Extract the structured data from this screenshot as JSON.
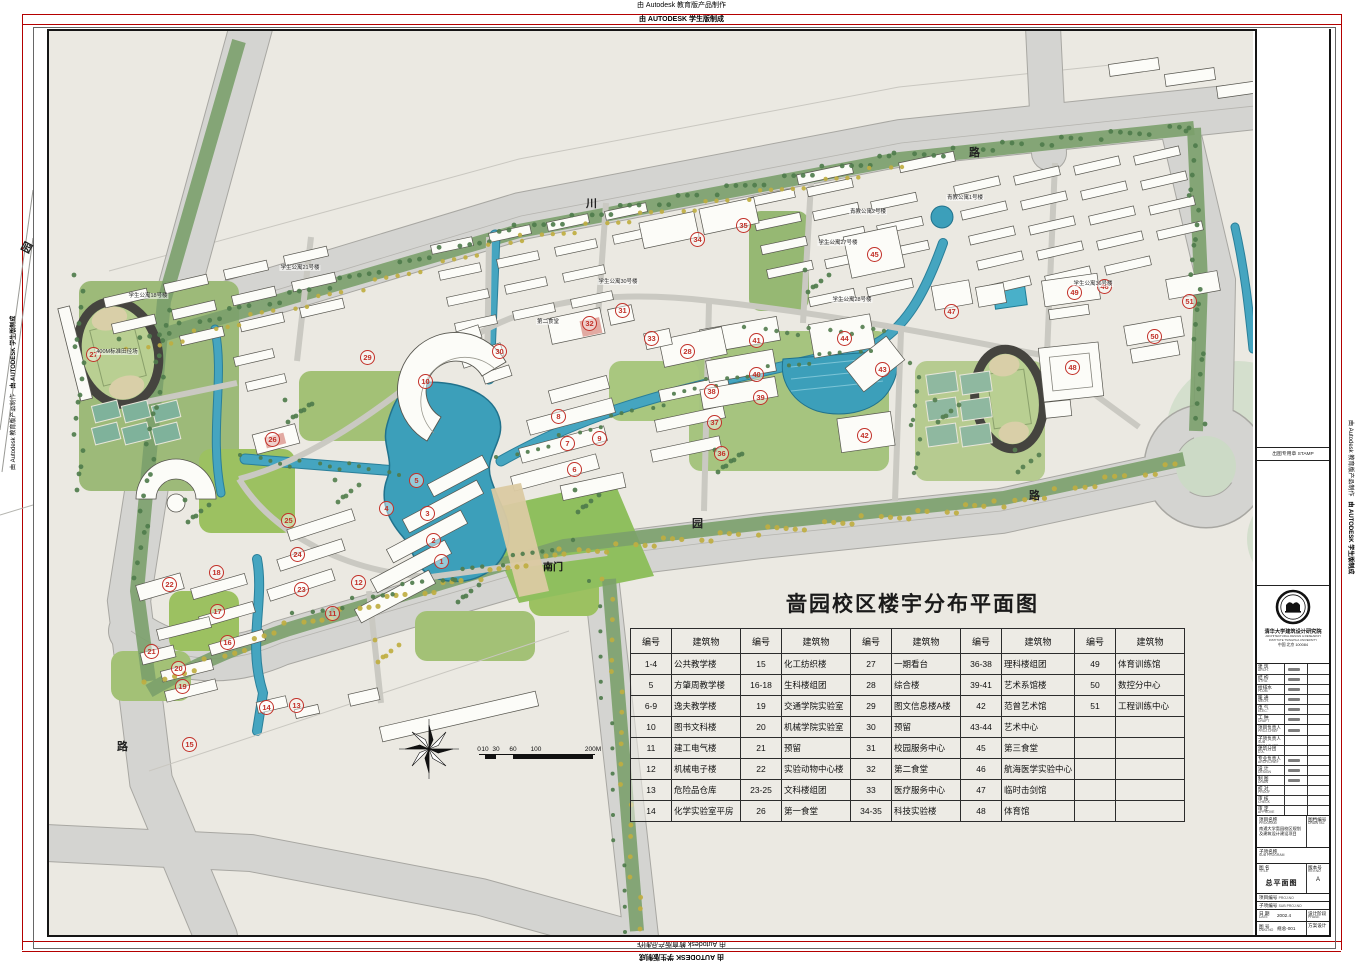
{
  "watermark": {
    "line1": "由 Autodesk 教育版产品制作",
    "line2": "由 AUTODESK 学生版制成"
  },
  "title": "啬园校区楼宇分布平面图",
  "legend_table": {
    "id_header": "编号",
    "name_header": "建筑物",
    "columns": [
      [
        {
          "id": "1-4",
          "name": "公共教学楼"
        },
        {
          "id": "5",
          "name": "方肇周教学楼"
        },
        {
          "id": "6-9",
          "name": "逸夫教学楼"
        },
        {
          "id": "10",
          "name": "图书文科楼"
        },
        {
          "id": "11",
          "name": "建工电气楼"
        },
        {
          "id": "12",
          "name": "机械电子楼"
        },
        {
          "id": "13",
          "name": "危险品仓库"
        },
        {
          "id": "14",
          "name": "化学实验室平房"
        }
      ],
      [
        {
          "id": "15",
          "name": "化工纺织楼"
        },
        {
          "id": "16-18",
          "name": "生科楼组团"
        },
        {
          "id": "19",
          "name": "交通学院实验室"
        },
        {
          "id": "20",
          "name": "机械学院实验室"
        },
        {
          "id": "21",
          "name": "预留"
        },
        {
          "id": "22",
          "name": "实验动物中心楼"
        },
        {
          "id": "23-25",
          "name": "文科楼组团"
        },
        {
          "id": "26",
          "name": "第一食堂"
        }
      ],
      [
        {
          "id": "27",
          "name": "一期看台"
        },
        {
          "id": "28",
          "name": "综合楼"
        },
        {
          "id": "29",
          "name": "图文信息楼A楼"
        },
        {
          "id": "30",
          "name": "预留"
        },
        {
          "id": "31",
          "name": "校园服务中心"
        },
        {
          "id": "32",
          "name": "第二食堂"
        },
        {
          "id": "33",
          "name": "医疗服务中心"
        },
        {
          "id": "34-35",
          "name": "科技实验楼"
        }
      ],
      [
        {
          "id": "36-38",
          "name": "理科楼组团"
        },
        {
          "id": "39-41",
          "name": "艺术系馆楼"
        },
        {
          "id": "42",
          "name": "范曾艺术馆"
        },
        {
          "id": "43-44",
          "name": "艺术中心"
        },
        {
          "id": "45",
          "name": "第三食堂"
        },
        {
          "id": "46",
          "name": "航海医学实验中心"
        },
        {
          "id": "47",
          "name": "临时击剑馆"
        },
        {
          "id": "48",
          "name": "体育馆"
        }
      ],
      [
        {
          "id": "49",
          "name": "体育训练馆"
        },
        {
          "id": "50",
          "name": "数控分中心"
        },
        {
          "id": "51",
          "name": "工程训练中心"
        },
        {
          "id": "",
          "name": ""
        },
        {
          "id": "",
          "name": ""
        },
        {
          "id": "",
          "name": ""
        },
        {
          "id": "",
          "name": ""
        },
        {
          "id": "",
          "name": ""
        }
      ]
    ]
  },
  "map": {
    "colors": {
      "water": "#45a5c0",
      "road": "#d4d4d1",
      "marker_red": "#c23028",
      "lawn": "#9cc161"
    },
    "markers": [
      {
        "n": 1,
        "x": 442,
        "y": 562
      },
      {
        "n": 2,
        "x": 434,
        "y": 541
      },
      {
        "n": 3,
        "x": 428,
        "y": 514
      },
      {
        "n": 4,
        "x": 387,
        "y": 509
      },
      {
        "n": 5,
        "x": 417,
        "y": 481
      },
      {
        "n": 6,
        "x": 575,
        "y": 470
      },
      {
        "n": 7,
        "x": 568,
        "y": 444
      },
      {
        "n": 8,
        "x": 559,
        "y": 417
      },
      {
        "n": 9,
        "x": 600,
        "y": 439
      },
      {
        "n": 10,
        "x": 426,
        "y": 382
      },
      {
        "n": 11,
        "x": 333,
        "y": 614
      },
      {
        "n": 12,
        "x": 359,
        "y": 583
      },
      {
        "n": 13,
        "x": 297,
        "y": 706
      },
      {
        "n": 14,
        "x": 267,
        "y": 708
      },
      {
        "n": 15,
        "x": 190,
        "y": 745
      },
      {
        "n": 16,
        "x": 228,
        "y": 643
      },
      {
        "n": 17,
        "x": 218,
        "y": 612
      },
      {
        "n": 18,
        "x": 217,
        "y": 573
      },
      {
        "n": 19,
        "x": 183,
        "y": 687
      },
      {
        "n": 20,
        "x": 179,
        "y": 669
      },
      {
        "n": 21,
        "x": 152,
        "y": 652
      },
      {
        "n": 22,
        "x": 170,
        "y": 585
      },
      {
        "n": 23,
        "x": 302,
        "y": 590
      },
      {
        "n": 24,
        "x": 298,
        "y": 555
      },
      {
        "n": 25,
        "x": 289,
        "y": 521
      },
      {
        "n": 26,
        "x": 273,
        "y": 440
      },
      {
        "n": 27,
        "x": 94,
        "y": 355
      },
      {
        "n": 28,
        "x": 688,
        "y": 352
      },
      {
        "n": 29,
        "x": 368,
        "y": 358
      },
      {
        "n": 30,
        "x": 500,
        "y": 352
      },
      {
        "n": 31,
        "x": 623,
        "y": 311
      },
      {
        "n": 32,
        "x": 590,
        "y": 324
      },
      {
        "n": 33,
        "x": 652,
        "y": 339
      },
      {
        "n": 34,
        "x": 698,
        "y": 240
      },
      {
        "n": 35,
        "x": 744,
        "y": 226
      },
      {
        "n": 36,
        "x": 722,
        "y": 454
      },
      {
        "n": 37,
        "x": 715,
        "y": 423
      },
      {
        "n": 38,
        "x": 712,
        "y": 392
      },
      {
        "n": 39,
        "x": 761,
        "y": 398
      },
      {
        "n": 40,
        "x": 757,
        "y": 375
      },
      {
        "n": 41,
        "x": 757,
        "y": 341
      },
      {
        "n": 42,
        "x": 865,
        "y": 436
      },
      {
        "n": 43,
        "x": 883,
        "y": 370
      },
      {
        "n": 44,
        "x": 845,
        "y": 339
      },
      {
        "n": 45,
        "x": 875,
        "y": 255
      },
      {
        "n": 46,
        "x": 1105,
        "y": 287
      },
      {
        "n": 47,
        "x": 952,
        "y": 312
      },
      {
        "n": 48,
        "x": 1073,
        "y": 368
      },
      {
        "n": 49,
        "x": 1075,
        "y": 293
      },
      {
        "n": 50,
        "x": 1155,
        "y": 337
      },
      {
        "n": 51,
        "x": 1190,
        "y": 302
      }
    ],
    "road_labels": [
      {
        "text": "川",
        "x": 592,
        "y": 203,
        "rot": 0
      },
      {
        "text": "路",
        "x": 975,
        "y": 152,
        "rot": 0
      },
      {
        "text": "园",
        "x": 698,
        "y": 523,
        "rot": 0
      },
      {
        "text": "路",
        "x": 1035,
        "y": 495,
        "rot": 0
      },
      {
        "text": "路",
        "x": 123,
        "y": 746,
        "rot": 0
      },
      {
        "text": "园",
        "x": 27,
        "y": 247,
        "rot": -62
      }
    ],
    "gate_label": {
      "text": "南门",
      "x": 553,
      "y": 566
    },
    "building_labels": [
      {
        "text": "青教公寓1号楼",
        "x": 965,
        "y": 198
      },
      {
        "text": "青教公寓2号楼",
        "x": 868,
        "y": 212
      },
      {
        "text": "第二食堂",
        "x": 548,
        "y": 322
      },
      {
        "text": "学生公寓21号楼",
        "x": 300,
        "y": 268
      },
      {
        "text": "学生公寓18号楼",
        "x": 148,
        "y": 296
      },
      {
        "text": "学生公寓27号楼",
        "x": 838,
        "y": 243
      },
      {
        "text": "学生公寓28号楼",
        "x": 852,
        "y": 300
      },
      {
        "text": "学生公寓30号楼",
        "x": 618,
        "y": 282
      },
      {
        "text": "学生公寓36号楼",
        "x": 1093,
        "y": 284
      },
      {
        "text": "400M标准田径场",
        "x": 117,
        "y": 352
      }
    ],
    "scale_bar": {
      "ticks": [
        "0",
        "10",
        "30",
        "60",
        "100",
        "200M"
      ]
    }
  },
  "title_block": {
    "stamp_label": "出图专用章 STAMP",
    "institute": {
      "name": "清华大学建筑设计研究院",
      "sub": "ARCHITECTURAL DESIGN & RESEARCH INSTITUTE TSINGHUA UNIVERSITY",
      "addr": "中国 北京 100084"
    },
    "disciplines": [
      {
        "cn": "建 筑",
        "en": "ARCH."
      },
      {
        "cn": "结 构",
        "en": "STRU."
      },
      {
        "cn": "给排水",
        "en": "PLUM."
      },
      {
        "cn": "暖 通",
        "en": "MECH."
      },
      {
        "cn": "电 气",
        "en": "ELEC."
      },
      {
        "cn": "工 种",
        "en": "DRAFT"
      }
    ],
    "roles": [
      {
        "cn": "项目负责人",
        "en": "PROJ.CHIEF"
      },
      {
        "cn": "子项负责人",
        "en": "SUB PROJ.CHIEF"
      },
      {
        "cn": "建筑分团",
        "en": "D.A."
      },
      {
        "cn": "专业负责人",
        "en": "ARCH.CHIEF"
      },
      {
        "cn": "设 计",
        "en": "DESIGN"
      },
      {
        "cn": "制 图",
        "en": "DRAW"
      },
      {
        "cn": "校 对",
        "en": "PROOF"
      },
      {
        "cn": "审 核",
        "en": "CHECK"
      },
      {
        "cn": "审 定",
        "en": "APPROVE"
      }
    ],
    "program": {
      "label": "项目名称",
      "en": "PROGRAM",
      "value": "南通大学啬园校区规划及建筑设计建设项目"
    },
    "doc_no": {
      "label": "图档编号",
      "en": "DRAW NO."
    },
    "sub_program": {
      "label": "子项名称",
      "en": "SUB PROGRAM"
    },
    "drawing_title": {
      "label": "图 名",
      "en": "TITLE",
      "value": "总平面图"
    },
    "rev": {
      "label": "版本号",
      "en": "REV.NO",
      "value": "A"
    },
    "proj_no": {
      "label": "项目编号",
      "en": "PROJ.NO"
    },
    "sub_proj_no": {
      "label": "子项编号",
      "en": "SUB PROJ.NO"
    },
    "date": {
      "label": "日 期",
      "en": "DATE",
      "value": "2002.4"
    },
    "phase": {
      "label": "设计阶段",
      "en": "PHASE",
      "value": "方案设计"
    },
    "dwg_no": {
      "label": "图 号",
      "en": "DWG.NO",
      "value": "规总-001"
    }
  }
}
